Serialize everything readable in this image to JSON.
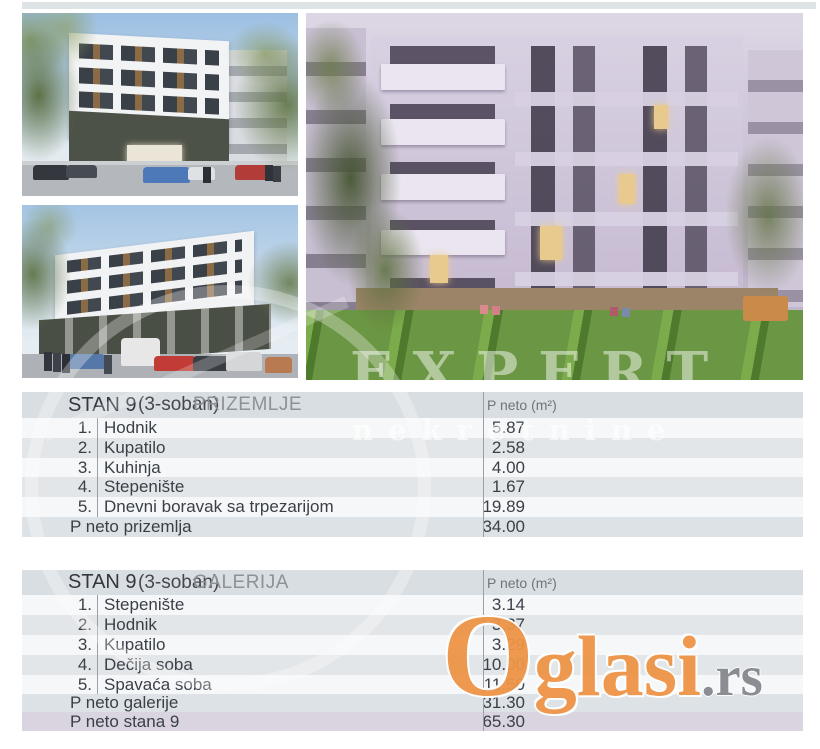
{
  "watermarks": {
    "brand": "EXPERT",
    "brand_sub": "nekretnine",
    "portal_initial": "O",
    "portal_rest": "glasi",
    "portal_tld": ".rs",
    "portal_color": "#ee9447",
    "portal_tld_color": "#85888d"
  },
  "tables": [
    {
      "title_stan": "STAN 9",
      "title_type": "(3-soban)",
      "title_level": "PRIZEMLJE",
      "col_area": "P neto (m²)",
      "rows": [
        {
          "num": "1.",
          "name": "Hodnik",
          "value": "5.87"
        },
        {
          "num": "2.",
          "name": "Kupatilo",
          "value": "2.58"
        },
        {
          "num": "3.",
          "name": "Kuhinja",
          "value": "4.00"
        },
        {
          "num": "4.",
          "name": "Stepenište",
          "value": "1.67"
        },
        {
          "num": "5.",
          "name": "Dnevni boravak sa trpezarijom",
          "value": "19.89"
        }
      ],
      "totals": [
        {
          "label": "P neto prizemlja",
          "value": "34.00"
        }
      ]
    },
    {
      "title_stan": "STAN 9",
      "title_type": "(3-soban)",
      "title_level": "GALERIJA",
      "col_area": "P neto (m²)",
      "rows": [
        {
          "num": "1.",
          "name": "Stepenište",
          "value": "3.14"
        },
        {
          "num": "2.",
          "name": "Hodnik",
          "value": "3.37"
        },
        {
          "num": "3.",
          "name": "Kupatilo",
          "value": "3.29"
        },
        {
          "num": "4.",
          "name": "Dečija soba",
          "value": "10.00"
        },
        {
          "num": "5.",
          "name": "Spavaća soba",
          "value": "11.50"
        }
      ],
      "totals": [
        {
          "label": "P neto galerije",
          "value": "31.30"
        },
        {
          "label": "P neto stana 9",
          "value": "65.30"
        }
      ]
    }
  ]
}
